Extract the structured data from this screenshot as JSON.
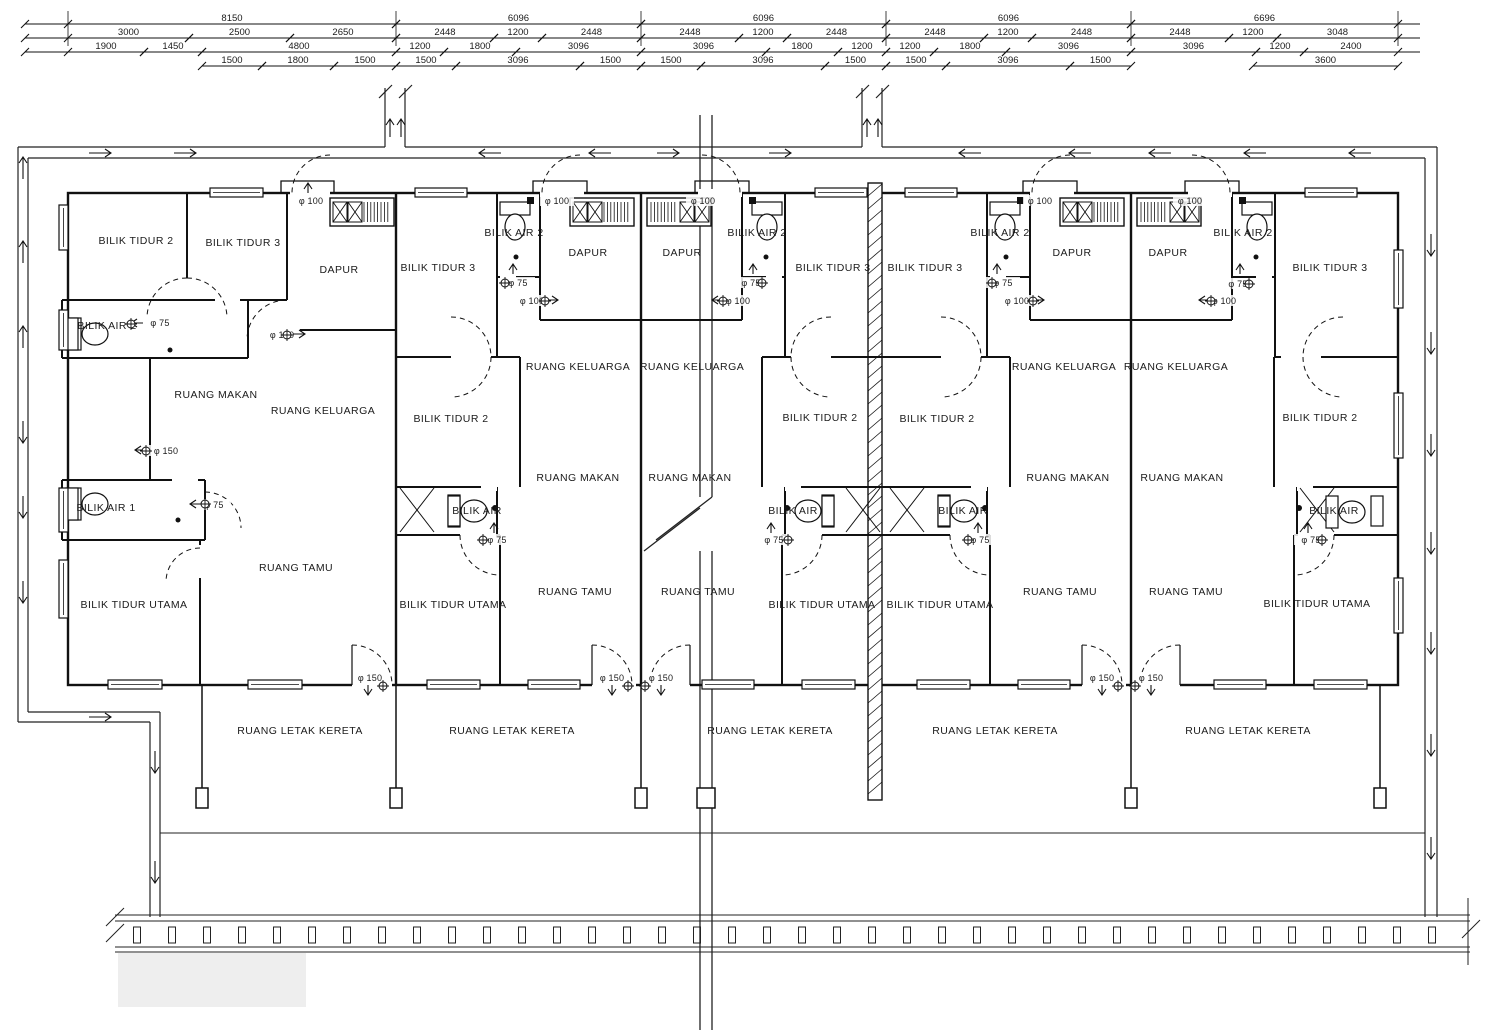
{
  "plan": {
    "rooms": [
      {
        "label": "BILIK TIDUR 2",
        "x": 136,
        "y": 244
      },
      {
        "label": "BILIK TIDUR 3",
        "x": 243,
        "y": 246
      },
      {
        "label": "DAPUR",
        "x": 339,
        "y": 273
      },
      {
        "label": "BILIK AIR 2",
        "x": 107,
        "y": 329
      },
      {
        "label": "RUANG MAKAN",
        "x": 216,
        "y": 398
      },
      {
        "label": "RUANG KELUARGA",
        "x": 323,
        "y": 414
      },
      {
        "label": "BILIK AIR 1",
        "x": 106,
        "y": 511
      },
      {
        "label": "RUANG TAMU",
        "x": 296,
        "y": 571
      },
      {
        "label": "BILIK TIDUR UTAMA",
        "x": 134,
        "y": 608
      },
      {
        "label": "BILIK TIDUR 3",
        "x": 438,
        "y": 271
      },
      {
        "label": "BILIK AIR 2",
        "x": 514,
        "y": 236
      },
      {
        "label": "DAPUR",
        "x": 588,
        "y": 256
      },
      {
        "label": "RUANG KELUARGA",
        "x": 578,
        "y": 370
      },
      {
        "label": "BILIK TIDUR 2",
        "x": 451,
        "y": 422
      },
      {
        "label": "RUANG MAKAN",
        "x": 578,
        "y": 481
      },
      {
        "label": "BILIK AIR",
        "x": 477,
        "y": 514
      },
      {
        "label": "RUANG TAMU",
        "x": 575,
        "y": 595
      },
      {
        "label": "BILIK TIDUR UTAMA",
        "x": 453,
        "y": 608
      },
      {
        "label": "DAPUR",
        "x": 682,
        "y": 256
      },
      {
        "label": "BILIK AIR 2",
        "x": 757,
        "y": 236
      },
      {
        "label": "BILIK TIDUR 3",
        "x": 833,
        "y": 271
      },
      {
        "label": "RUANG KELUARGA",
        "x": 692,
        "y": 370
      },
      {
        "label": "BILIK TIDUR 2",
        "x": 820,
        "y": 421
      },
      {
        "label": "RUANG MAKAN",
        "x": 690,
        "y": 481
      },
      {
        "label": "BILIK AIR",
        "x": 793,
        "y": 514
      },
      {
        "label": "RUANG TAMU",
        "x": 698,
        "y": 595
      },
      {
        "label": "BILIK TIDUR UTAMA",
        "x": 822,
        "y": 608
      },
      {
        "label": "BILIK TIDUR 3",
        "x": 925,
        "y": 271
      },
      {
        "label": "BILIK AIR 2",
        "x": 1000,
        "y": 236
      },
      {
        "label": "DAPUR",
        "x": 1072,
        "y": 256
      },
      {
        "label": "RUANG KELUARGA",
        "x": 1064,
        "y": 370
      },
      {
        "label": "BILIK TIDUR 2",
        "x": 937,
        "y": 422
      },
      {
        "label": "RUANG MAKAN",
        "x": 1068,
        "y": 481
      },
      {
        "label": "BILIK AIR",
        "x": 963,
        "y": 514
      },
      {
        "label": "RUANG TAMU",
        "x": 1060,
        "y": 595
      },
      {
        "label": "BILIK TIDUR UTAMA",
        "x": 940,
        "y": 608
      },
      {
        "label": "DAPUR",
        "x": 1168,
        "y": 256
      },
      {
        "label": "BILIK AIR 2",
        "x": 1243,
        "y": 236
      },
      {
        "label": "BILIK TIDUR 3",
        "x": 1330,
        "y": 271
      },
      {
        "label": "RUANG KELUARGA",
        "x": 1176,
        "y": 370
      },
      {
        "label": "BILIK TIDUR 2",
        "x": 1320,
        "y": 421
      },
      {
        "label": "RUANG MAKAN",
        "x": 1182,
        "y": 481
      },
      {
        "label": "BILIK AIR",
        "x": 1334,
        "y": 514
      },
      {
        "label": "RUANG TAMU",
        "x": 1186,
        "y": 595
      },
      {
        "label": "BILIK TIDUR UTAMA",
        "x": 1317,
        "y": 607
      }
    ],
    "carpark_labels": [
      {
        "label": "RUANG LETAK KERETA",
        "x": 300,
        "y": 734
      },
      {
        "label": "RUANG LETAK KERETA",
        "x": 512,
        "y": 734
      },
      {
        "label": "RUANG LETAK KERETA",
        "x": 770,
        "y": 734
      },
      {
        "label": "RUANG LETAK KERETA",
        "x": 995,
        "y": 734
      },
      {
        "label": "RUANG LETAK KERETA",
        "x": 1248,
        "y": 734
      }
    ],
    "pipe_labels": [
      {
        "label": "φ 100",
        "x": 311,
        "y": 204
      },
      {
        "label": "φ 75",
        "x": 160,
        "y": 326
      },
      {
        "label": "φ 100",
        "x": 282,
        "y": 338
      },
      {
        "label": "φ 150",
        "x": 166,
        "y": 454
      },
      {
        "label": "φ 75",
        "x": 214,
        "y": 508
      },
      {
        "label": "φ 150",
        "x": 370,
        "y": 681
      },
      {
        "label": "φ 100",
        "x": 557,
        "y": 204
      },
      {
        "label": "φ 75",
        "x": 518,
        "y": 286
      },
      {
        "label": "φ 100",
        "x": 532,
        "y": 304
      },
      {
        "label": "φ 75",
        "x": 497,
        "y": 543
      },
      {
        "label": "φ 150",
        "x": 612,
        "y": 681
      },
      {
        "label": "φ 100",
        "x": 703,
        "y": 204
      },
      {
        "label": "φ 75",
        "x": 751,
        "y": 286
      },
      {
        "label": "φ 100",
        "x": 738,
        "y": 304
      },
      {
        "label": "φ 75",
        "x": 774,
        "y": 543
      },
      {
        "label": "φ 150",
        "x": 661,
        "y": 681
      },
      {
        "label": "φ 100",
        "x": 1040,
        "y": 204
      },
      {
        "label": "φ 75",
        "x": 1003,
        "y": 286
      },
      {
        "label": "φ 100",
        "x": 1017,
        "y": 304
      },
      {
        "label": "φ 75",
        "x": 980,
        "y": 543
      },
      {
        "label": "φ 150",
        "x": 1102,
        "y": 681
      },
      {
        "label": "φ 100",
        "x": 1190,
        "y": 204
      },
      {
        "label": "φ 75",
        "x": 1238,
        "y": 287
      },
      {
        "label": "φ 100",
        "x": 1224,
        "y": 304
      },
      {
        "label": "φ 75",
        "x": 1311,
        "y": 543
      },
      {
        "label": "φ 150",
        "x": 1151,
        "y": 681
      }
    ],
    "dimension_rows": [
      {
        "y": 24,
        "segments": [
          {
            "label": "8150",
            "x1": 68,
            "x2": 396
          },
          {
            "label": "6096",
            "x1": 396,
            "x2": 641
          },
          {
            "label": "6096",
            "x1": 641,
            "x2": 886
          },
          {
            "label": "6096",
            "x1": 886,
            "x2": 1131
          },
          {
            "label": "6696",
            "x1": 1131,
            "x2": 1398
          }
        ]
      },
      {
        "y": 38,
        "segments": [
          {
            "label": "3000",
            "x1": 68,
            "x2": 189
          },
          {
            "label": "2500",
            "x1": 189,
            "x2": 290
          },
          {
            "label": "2650",
            "x1": 290,
            "x2": 396
          },
          {
            "label": "2448",
            "x1": 396,
            "x2": 494
          },
          {
            "label": "1200",
            "x1": 494,
            "x2": 542
          },
          {
            "label": "2448",
            "x1": 542,
            "x2": 641
          },
          {
            "label": "2448",
            "x1": 641,
            "x2": 739
          },
          {
            "label": "1200",
            "x1": 739,
            "x2": 787
          },
          {
            "label": "2448",
            "x1": 787,
            "x2": 886
          },
          {
            "label": "2448",
            "x1": 886,
            "x2": 984
          },
          {
            "label": "1200",
            "x1": 984,
            "x2": 1032
          },
          {
            "label": "2448",
            "x1": 1032,
            "x2": 1131
          },
          {
            "label": "2448",
            "x1": 1131,
            "x2": 1229
          },
          {
            "label": "1200",
            "x1": 1229,
            "x2": 1277
          },
          {
            "label": "3048",
            "x1": 1277,
            "x2": 1398
          }
        ]
      },
      {
        "y": 52,
        "segments": [
          {
            "label": "1900",
            "x1": 68,
            "x2": 144
          },
          {
            "label": "1450",
            "x1": 144,
            "x2": 202
          },
          {
            "label": "4800",
            "x1": 202,
            "x2": 396
          },
          {
            "label": "1200",
            "x1": 396,
            "x2": 444
          },
          {
            "label": "1800",
            "x1": 444,
            "x2": 516
          },
          {
            "label": "3096",
            "x1": 516,
            "x2": 641
          },
          {
            "label": "3096",
            "x1": 641,
            "x2": 766
          },
          {
            "label": "1800",
            "x1": 766,
            "x2": 838
          },
          {
            "label": "1200",
            "x1": 838,
            "x2": 886
          },
          {
            "label": "1200",
            "x1": 886,
            "x2": 934
          },
          {
            "label": "1800",
            "x1": 934,
            "x2": 1006
          },
          {
            "label": "3096",
            "x1": 1006,
            "x2": 1131
          },
          {
            "label": "3096",
            "x1": 1131,
            "x2": 1256
          },
          {
            "label": "1200",
            "x1": 1256,
            "x2": 1304
          },
          {
            "label": "2400",
            "x1": 1304,
            "x2": 1398
          }
        ]
      },
      {
        "y": 66,
        "segments": [
          {
            "label": "1500",
            "x1": 202,
            "x2": 262
          },
          {
            "label": "1800",
            "x1": 262,
            "x2": 334
          },
          {
            "label": "1500",
            "x1": 334,
            "x2": 396
          },
          {
            "label": "1500",
            "x1": 396,
            "x2": 456
          },
          {
            "label": "3096",
            "x1": 456,
            "x2": 580
          },
          {
            "label": "1500",
            "x1": 580,
            "x2": 641
          },
          {
            "label": "1500",
            "x1": 641,
            "x2": 701
          },
          {
            "label": "3096",
            "x1": 701,
            "x2": 825
          },
          {
            "label": "1500",
            "x1": 825,
            "x2": 886
          },
          {
            "label": "1500",
            "x1": 886,
            "x2": 946
          },
          {
            "label": "3096",
            "x1": 946,
            "x2": 1070
          },
          {
            "label": "1500",
            "x1": 1070,
            "x2": 1131
          },
          {
            "label": "3600",
            "x1": 1253,
            "x2": 1398
          }
        ]
      }
    ],
    "flow_arrows": [
      {
        "x": 100,
        "y": 153,
        "dir": "right",
        "s": 22
      },
      {
        "x": 185,
        "y": 153,
        "dir": "right",
        "s": 22
      },
      {
        "x": 490,
        "y": 153,
        "dir": "left",
        "s": 22
      },
      {
        "x": 600,
        "y": 153,
        "dir": "left",
        "s": 22
      },
      {
        "x": 668,
        "y": 153,
        "dir": "right",
        "s": 22
      },
      {
        "x": 780,
        "y": 153,
        "dir": "right",
        "s": 22
      },
      {
        "x": 970,
        "y": 153,
        "dir": "left",
        "s": 22
      },
      {
        "x": 1080,
        "y": 153,
        "dir": "left",
        "s": 22
      },
      {
        "x": 1160,
        "y": 153,
        "dir": "left",
        "s": 22
      },
      {
        "x": 1255,
        "y": 153,
        "dir": "left",
        "s": 22
      },
      {
        "x": 1360,
        "y": 153,
        "dir": "left",
        "s": 22
      },
      {
        "x": 23,
        "y": 168,
        "dir": "up",
        "s": 22
      },
      {
        "x": 23,
        "y": 252,
        "dir": "up",
        "s": 22
      },
      {
        "x": 23,
        "y": 337,
        "dir": "up",
        "s": 22
      },
      {
        "x": 23,
        "y": 432,
        "dir": "down",
        "s": 22
      },
      {
        "x": 23,
        "y": 507,
        "dir": "down",
        "s": 22
      },
      {
        "x": 23,
        "y": 592,
        "dir": "down",
        "s": 22
      },
      {
        "x": 100,
        "y": 717,
        "dir": "right",
        "s": 22
      },
      {
        "x": 155,
        "y": 762,
        "dir": "down",
        "s": 22
      },
      {
        "x": 155,
        "y": 872,
        "dir": "down",
        "s": 22
      },
      {
        "x": 1431,
        "y": 245,
        "dir": "down",
        "s": 22
      },
      {
        "x": 1431,
        "y": 343,
        "dir": "down",
        "s": 22
      },
      {
        "x": 1431,
        "y": 445,
        "dir": "down",
        "s": 22
      },
      {
        "x": 1431,
        "y": 543,
        "dir": "down",
        "s": 22
      },
      {
        "x": 1431,
        "y": 643,
        "dir": "down",
        "s": 22
      },
      {
        "x": 1431,
        "y": 745,
        "dir": "down",
        "s": 22
      },
      {
        "x": 1431,
        "y": 848,
        "dir": "down",
        "s": 22
      },
      {
        "x": 390,
        "y": 128,
        "dir": "up",
        "s": 18
      },
      {
        "x": 401,
        "y": 128,
        "dir": "up",
        "s": 18
      },
      {
        "x": 867,
        "y": 128,
        "dir": "up",
        "s": 18
      },
      {
        "x": 878,
        "y": 128,
        "dir": "up",
        "s": 18
      },
      {
        "x": 299,
        "y": 334,
        "dir": "right",
        "s": 12
      },
      {
        "x": 141,
        "y": 450,
        "dir": "left",
        "s": 12
      },
      {
        "x": 137,
        "y": 323,
        "dir": "left",
        "s": 12
      },
      {
        "x": 196,
        "y": 504,
        "dir": "left",
        "s": 12
      },
      {
        "x": 308,
        "y": 188,
        "dir": "up",
        "s": 10
      },
      {
        "x": 368,
        "y": 690,
        "dir": "down",
        "s": 10
      },
      {
        "x": 513,
        "y": 269,
        "dir": "up",
        "s": 10
      },
      {
        "x": 552,
        "y": 300,
        "dir": "right",
        "s": 12
      },
      {
        "x": 494,
        "y": 528,
        "dir": "up",
        "s": 10
      },
      {
        "x": 612,
        "y": 690,
        "dir": "down",
        "s": 10
      },
      {
        "x": 753,
        "y": 269,
        "dir": "up",
        "s": 10
      },
      {
        "x": 718,
        "y": 300,
        "dir": "left",
        "s": 12
      },
      {
        "x": 771,
        "y": 528,
        "dir": "up",
        "s": 10
      },
      {
        "x": 661,
        "y": 690,
        "dir": "down",
        "s": 10
      },
      {
        "x": 997,
        "y": 269,
        "dir": "up",
        "s": 10
      },
      {
        "x": 1038,
        "y": 300,
        "dir": "right",
        "s": 12
      },
      {
        "x": 978,
        "y": 528,
        "dir": "up",
        "s": 10
      },
      {
        "x": 1102,
        "y": 690,
        "dir": "down",
        "s": 10
      },
      {
        "x": 1240,
        "y": 269,
        "dir": "up",
        "s": 10
      },
      {
        "x": 1205,
        "y": 300,
        "dir": "left",
        "s": 12
      },
      {
        "x": 1308,
        "y": 528,
        "dir": "up",
        "s": 10
      },
      {
        "x": 1151,
        "y": 690,
        "dir": "down",
        "s": 10
      }
    ],
    "pipe_points": [
      {
        "x": 131,
        "y": 324
      },
      {
        "x": 146,
        "y": 451
      },
      {
        "x": 205,
        "y": 504
      },
      {
        "x": 505,
        "y": 283
      },
      {
        "x": 483,
        "y": 540
      },
      {
        "x": 762,
        "y": 283
      },
      {
        "x": 788,
        "y": 540
      },
      {
        "x": 992,
        "y": 283
      },
      {
        "x": 968,
        "y": 540
      },
      {
        "x": 1249,
        "y": 284
      },
      {
        "x": 1322,
        "y": 540
      },
      {
        "x": 545,
        "y": 301
      },
      {
        "x": 723,
        "y": 301
      },
      {
        "x": 1033,
        "y": 301
      },
      {
        "x": 1211,
        "y": 301
      },
      {
        "x": 287,
        "y": 335
      },
      {
        "x": 383,
        "y": 686
      },
      {
        "x": 628,
        "y": 686
      },
      {
        "x": 645,
        "y": 686
      },
      {
        "x": 1118,
        "y": 686
      },
      {
        "x": 1135,
        "y": 686
      }
    ]
  }
}
